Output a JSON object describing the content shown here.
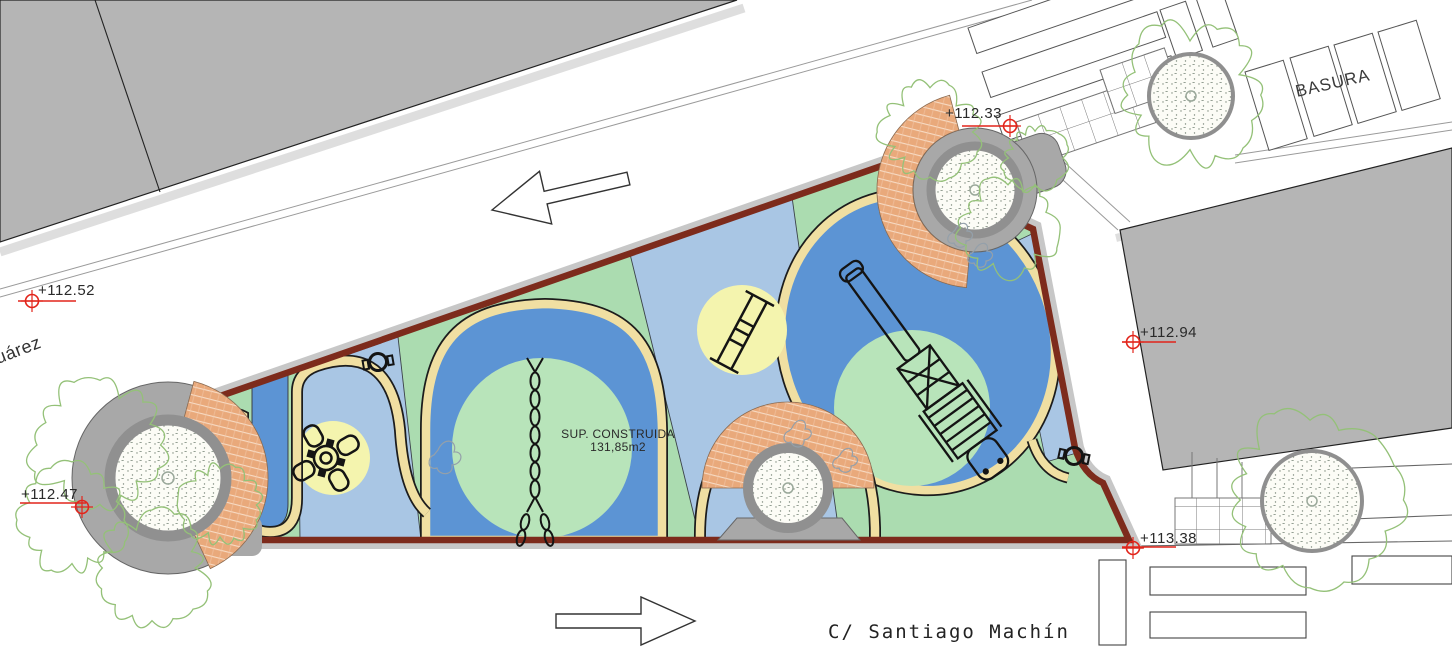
{
  "plan": {
    "area_note": {
      "line1": "SUP. CONSTRUIDA",
      "line2": "131,85m2"
    },
    "streets": {
      "bottom": "C/ Santiago Machín",
      "left_partial": "uárez"
    },
    "zones": {
      "trash_label": "BASURA"
    },
    "elevation_markers": [
      {
        "position": "northwest",
        "value": "+112.52"
      },
      {
        "position": "west",
        "value": "+112.47"
      },
      {
        "position": "north",
        "value": "+112.33"
      },
      {
        "position": "east",
        "value": "+112.94"
      },
      {
        "position": "southeast",
        "value": "+113.38"
      }
    ],
    "colors": {
      "building_gray": "#b5b5b5",
      "sidewalk_gray": "#c7c7c7",
      "wall_maroon": "#7d2b1c",
      "turf_green": "#abdcb0",
      "turf_light_blue": "#a9c6e4",
      "turf_blue": "#5c94d4",
      "circle_yellow": "#f4f4ae",
      "circle_green": "#b8e4ba",
      "path_cream": "#f0dfa2",
      "brick_orange": "#e9a97b",
      "marker_red": "#e2251b",
      "tree_green": "#94c178"
    }
  }
}
